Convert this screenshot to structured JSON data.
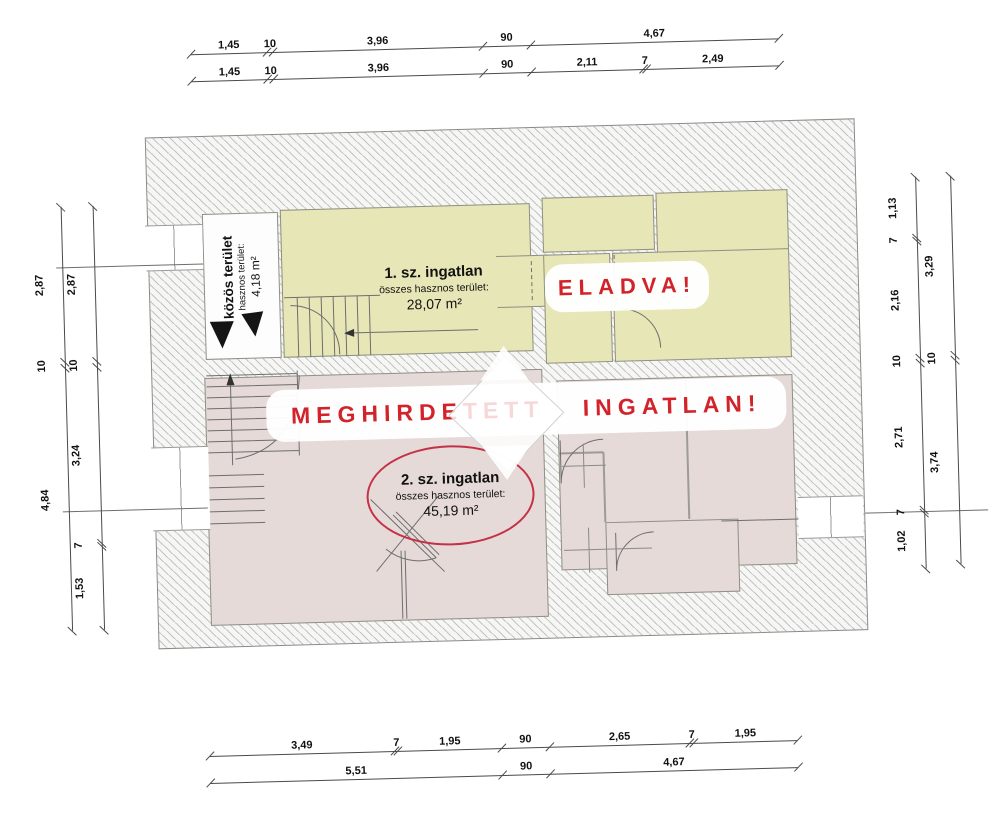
{
  "banners": {
    "advertised": "MEGHIRDETETT INGATLAN!",
    "sold": "ELADVA!"
  },
  "units": {
    "common": {
      "name": "közös terület",
      "area_label": "hasznos terület:",
      "area": "4,18 m²"
    },
    "unit1": {
      "name": "1. sz. ingatlan",
      "area_label": "összes hasznos terület:",
      "area": "28,07 m²"
    },
    "unit2": {
      "name": "2. sz. ingatlan",
      "area_label": "összes hasznos terület:",
      "area": "45,19 m²"
    }
  },
  "colors": {
    "unit1_fill": "#e7e6b6",
    "unit2_fill": "#e5dad8",
    "highlight_red": "#d2232a",
    "ellipse_red": "#c53147"
  },
  "dimensions": {
    "top_row1": [
      "1,45",
      "10",
      "3,96",
      "90",
      "4,67"
    ],
    "top_row2": [
      "1,45",
      "10",
      "3,96",
      "90",
      "2,11",
      "7",
      "2,49"
    ],
    "bottom_row1": [
      "3,49",
      "7",
      "1,95",
      "90",
      "2,65",
      "7",
      "1,95"
    ],
    "bottom_row2": [
      "5,51",
      "90",
      "4,67"
    ],
    "left_outer": [
      "2,87",
      "10",
      "4,84"
    ],
    "left_inner": [
      "2,87",
      "10",
      "3,24",
      "7",
      "1,53"
    ],
    "right_inner": [
      "1,13",
      "7",
      "2,16",
      "10",
      "2,71",
      "7",
      "1,02"
    ],
    "right_outer": [
      "3,29",
      "10",
      "3,74"
    ]
  }
}
